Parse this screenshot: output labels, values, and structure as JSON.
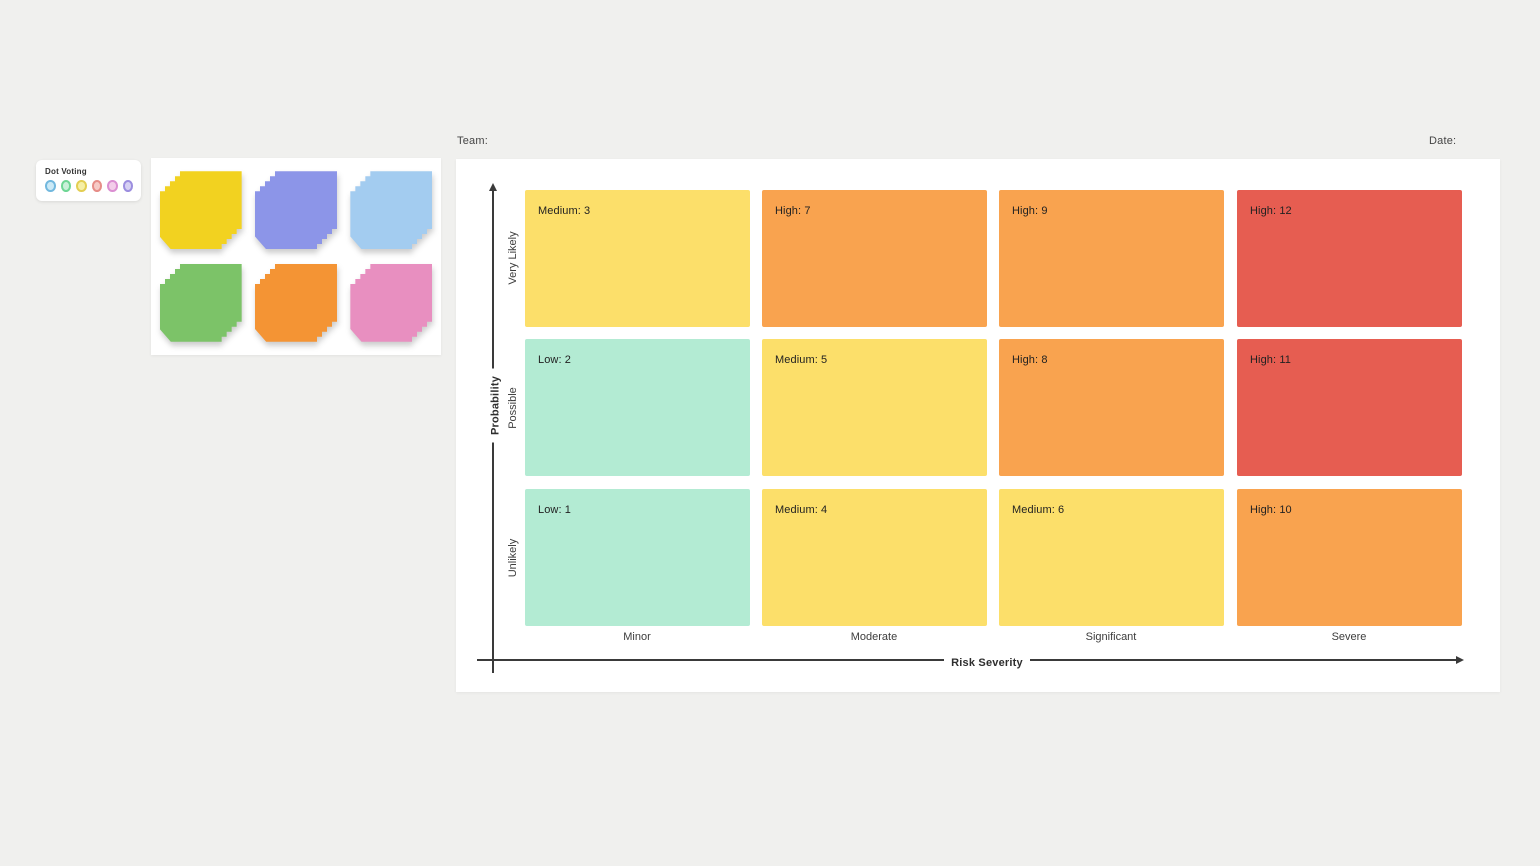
{
  "dot_voting": {
    "title": "Dot Voting",
    "dots": [
      {
        "name": "blue",
        "fill": "#cbe9f6",
        "border": "#72b8de"
      },
      {
        "name": "green",
        "fill": "#c9f0d9",
        "border": "#6fd695"
      },
      {
        "name": "yellow",
        "fill": "#f6efa5",
        "border": "#e3ce52"
      },
      {
        "name": "red",
        "fill": "#f6cac6",
        "border": "#e68d88"
      },
      {
        "name": "pink",
        "fill": "#f3cde9",
        "border": "#db8fd2"
      },
      {
        "name": "purple",
        "fill": "#d6d0f3",
        "border": "#9c8edf"
      }
    ]
  },
  "sticky_notes": {
    "stacks": [
      {
        "name": "yellow",
        "color": "#f2d220"
      },
      {
        "name": "purple",
        "color": "#8c95e8"
      },
      {
        "name": "blue",
        "color": "#a3ccf0"
      },
      {
        "name": "green",
        "color": "#7cc368"
      },
      {
        "name": "orange",
        "color": "#f49434"
      },
      {
        "name": "pink",
        "color": "#e88fc0"
      }
    ]
  },
  "header": {
    "team_label": "Team:",
    "date_label": "Date:"
  },
  "matrix": {
    "x_axis_label": "Risk Severity",
    "y_axis_label": "Probability",
    "columns": [
      "Minor",
      "Moderate",
      "Significant",
      "Severe"
    ],
    "rows": [
      "Very Likely",
      "Possible",
      "Unlikely"
    ],
    "cells": [
      [
        {
          "label": "Medium: 3",
          "color": "#fcdf6a"
        },
        {
          "label": "High: 7",
          "color": "#f9a34f"
        },
        {
          "label": "High: 9",
          "color": "#f9a34f"
        },
        {
          "label": "High: 12",
          "color": "#e65d51"
        }
      ],
      [
        {
          "label": "Low: 2",
          "color": "#b3ebd3"
        },
        {
          "label": "Medium: 5",
          "color": "#fcdf6a"
        },
        {
          "label": "High: 8",
          "color": "#f9a34f"
        },
        {
          "label": "High: 11",
          "color": "#e65d51"
        }
      ],
      [
        {
          "label": "Low: 1",
          "color": "#b3ebd3"
        },
        {
          "label": "Medium: 4",
          "color": "#fcdf6a"
        },
        {
          "label": "Medium: 6",
          "color": "#fcdf6a"
        },
        {
          "label": "High: 10",
          "color": "#f9a34f"
        }
      ]
    ]
  }
}
